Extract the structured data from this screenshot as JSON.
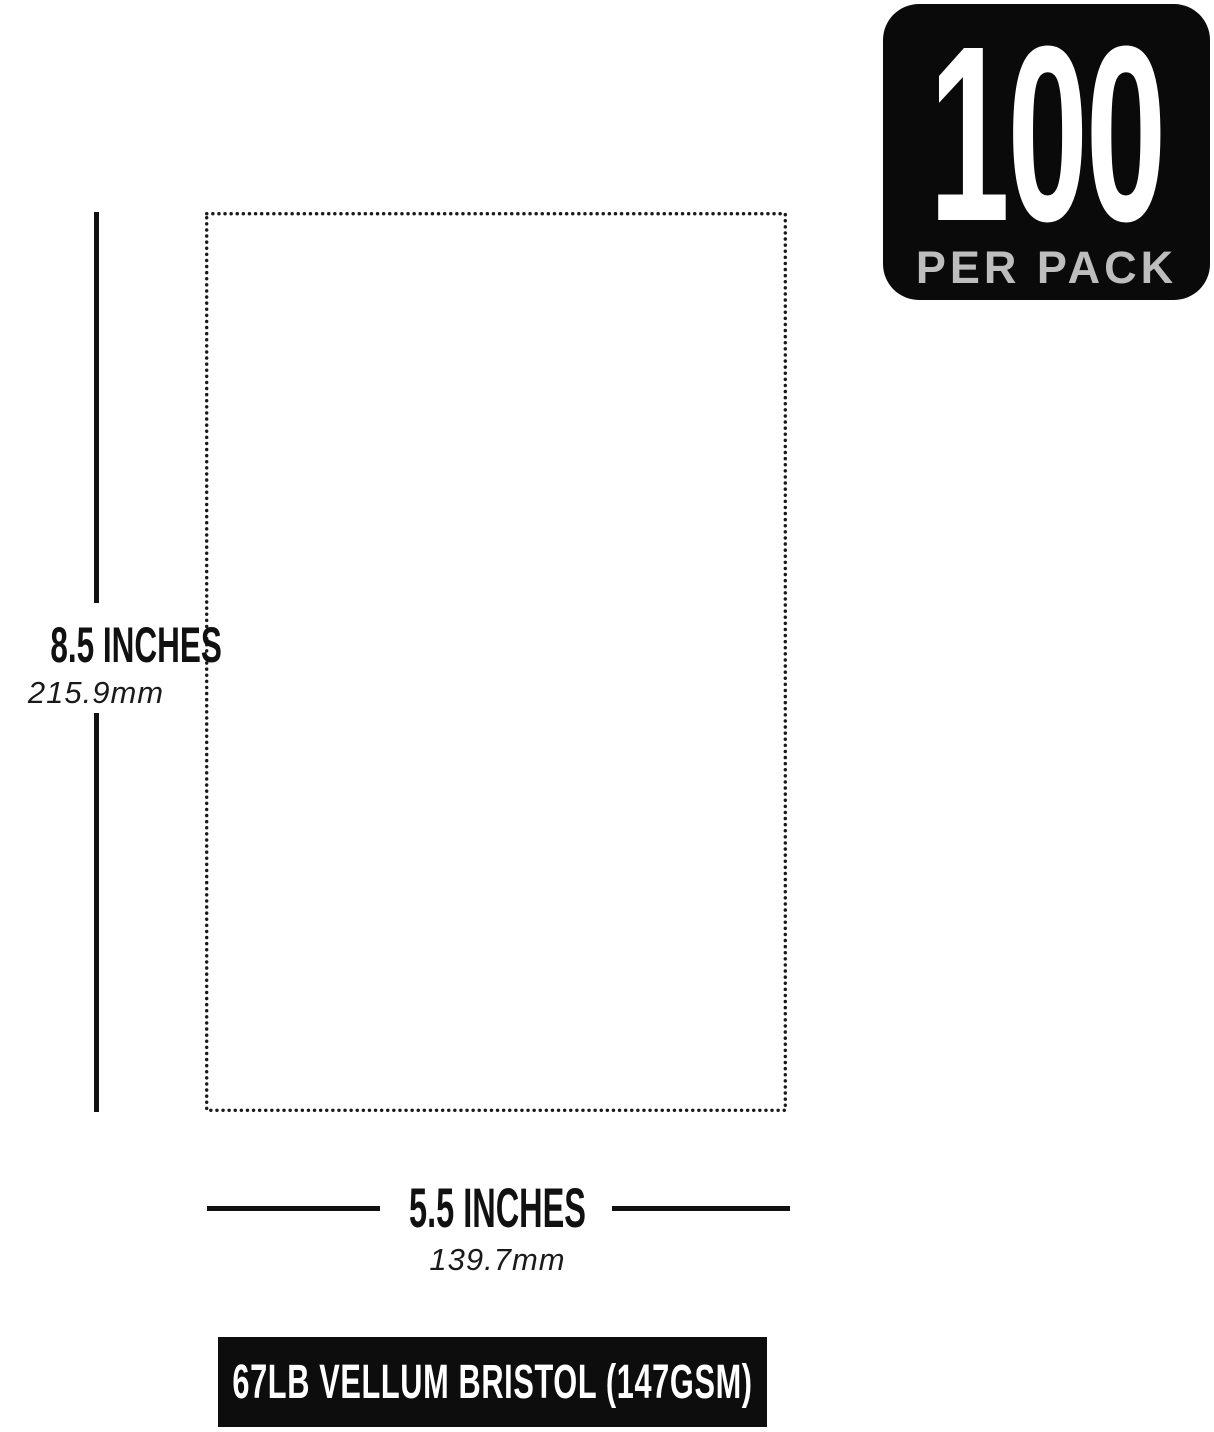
{
  "page": {
    "background_color": "#ffffff",
    "ink_color": "#111111"
  },
  "badge": {
    "count": "100",
    "label": "PER PACK",
    "bg_color": "#0a0a0a",
    "count_color": "#ffffff",
    "label_color": "#bdbdbd"
  },
  "paper": {
    "outline_style": "dotted",
    "outline_color": "#1a1a1a"
  },
  "height_dimension": {
    "inches": "8.5 INCHES",
    "mm": "215.9mm"
  },
  "width_dimension": {
    "inches": "5.5 INCHES",
    "mm": "139.7mm"
  },
  "footer": {
    "label": "67LB VELLUM BRISTOL (147GSM)",
    "bg_color": "#0d0d0d",
    "text_color": "#ffffff"
  }
}
